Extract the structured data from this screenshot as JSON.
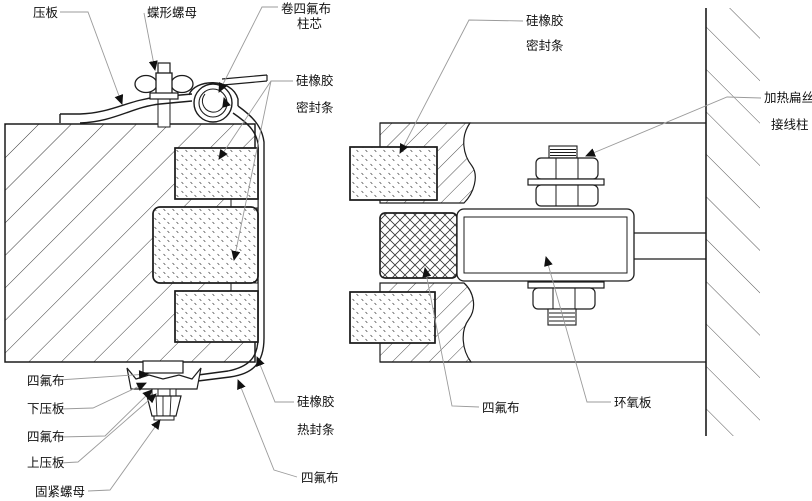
{
  "colors": {
    "background": "#ffffff",
    "line": "#1c1c1c",
    "leader": "#9b9b9b",
    "text": "#111111"
  },
  "labels": {
    "pressure_plate": "压板",
    "wing_nut": "蝶形螺母",
    "rolled_ptfe_core_l1": "卷四氟布",
    "rolled_ptfe_core_l2": "柱芯",
    "silicone_seal_left_l1": "硅橡胶",
    "silicone_seal_left_l2": "密封条",
    "silicone_seal_right_l1": "硅橡胶",
    "silicone_seal_right_l2": "密封条",
    "heating_flat_wire": "加热扁丝",
    "terminal_post": "接线柱",
    "ptfe_cloth_under_block": "四氟布",
    "lower_pressure_plate": "下压板",
    "ptfe_cloth_bolt": "四氟布",
    "upper_pressure_plate": "上压板",
    "fastening_nut": "固紧螺母",
    "silicone_heat_seal_l1": "硅橡胶",
    "silicone_heat_seal_l2": "热封条",
    "ptfe_cloth_wrap": "四氟布",
    "ptfe_cloth_right": "四氟布",
    "epoxy_board": "环氧板"
  }
}
